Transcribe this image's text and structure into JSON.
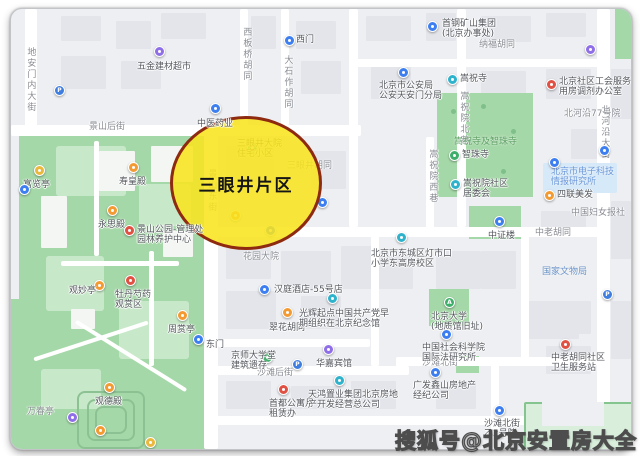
{
  "overlay": {
    "label": "三眼井片区"
  },
  "watermark": {
    "text": "搜狐号@北京安置房大全"
  },
  "colors": {
    "ellipse_fill": "rgba(248,228,31,0.88)",
    "ellipse_border": "#8e2a10",
    "park_green": "#a5d8a8",
    "road": "#ffffff",
    "highlight_block_blue": "#d6e9f8",
    "poi": {
      "B": "#3d7ef0",
      "T": "#2fb3cc",
      "G": "#3fae6a",
      "O": "#f39a33",
      "R": "#e05043",
      "P": "#8f6fe8",
      "K": "#3f7de0",
      "Y": "#e9b83d"
    }
  },
  "map": {
    "street_labels": [
      {
        "t": "地安门内大街",
        "x": 14,
        "y": 38,
        "v": 1
      },
      {
        "t": "景山后街",
        "x": 78,
        "y": 113
      },
      {
        "t": "西板桥胡同",
        "x": 230,
        "y": 18,
        "v": 1
      },
      {
        "t": "大石作胡同",
        "x": 271,
        "y": 46,
        "v": 1
      },
      {
        "t": "纳福胡同",
        "x": 468,
        "y": 31
      },
      {
        "t": "嵩祝院北巷",
        "x": 447,
        "y": 82,
        "v": 1
      },
      {
        "t": "景山东街",
        "x": 195,
        "y": 160,
        "v": 1
      },
      {
        "t": "嵩祝院西巷",
        "x": 416,
        "y": 140,
        "v": 1
      },
      {
        "t": "中老胡同",
        "x": 524,
        "y": 219
      },
      {
        "t": "沙滩后街",
        "x": 246,
        "y": 359
      },
      {
        "t": "沙滩北街",
        "x": 411,
        "y": 349
      },
      {
        "t": "北河沿大街",
        "x": 588,
        "y": 96,
        "v": 1
      },
      {
        "t": "花园大院",
        "x": 232,
        "y": 243
      },
      {
        "t": "万春亭",
        "x": 16,
        "y": 398
      },
      {
        "t": "北河沿77号院",
        "x": 553,
        "y": 100
      },
      {
        "t": "中国妇女报社",
        "x": 560,
        "y": 199
      }
    ],
    "area_labels": [
      {
        "t": "嵩祝寺及智珠寺",
        "x": 443,
        "y": 128,
        "c": "#5d9e63"
      },
      {
        "t": "国家文物局",
        "x": 531,
        "y": 258,
        "c": "#6b93c8"
      },
      {
        "t": "北京市电子科技\n情报研究所",
        "x": 540,
        "y": 158,
        "c": "#6b97d9"
      }
    ],
    "pois": [
      {
        "x": 147,
        "y": 41,
        "c": "P",
        "l": "五金建材超市",
        "lx": 126,
        "ly": 53
      },
      {
        "x": 203,
        "y": 98,
        "c": "B",
        "l": "中医药业",
        "lx": 186,
        "ly": 110
      },
      {
        "x": 47,
        "y": 80,
        "c": "K",
        "g": "P"
      },
      {
        "x": 277,
        "y": 30,
        "c": "B",
        "l": "西门",
        "lx": 285,
        "ly": 26
      },
      {
        "x": 420,
        "y": 16,
        "c": "B",
        "l": "首钢矿山集团\n(北京办事处)",
        "lx": 431,
        "ly": 10
      },
      {
        "x": 391,
        "y": 62,
        "c": "B",
        "l": "北京市公安局\n公安天安门分局",
        "lx": 368,
        "ly": 72
      },
      {
        "x": 440,
        "y": 69,
        "c": "T",
        "l": "嵩祝寺",
        "lx": 449,
        "ly": 65
      },
      {
        "x": 539,
        "y": 74,
        "c": "R",
        "l": "北京社区工会服务\n用房调剂办公室",
        "lx": 548,
        "ly": 68
      },
      {
        "x": 592,
        "y": 140,
        "c": "B"
      },
      {
        "x": 578,
        "y": 39,
        "c": "P"
      },
      {
        "x": 442,
        "y": 145,
        "c": "G",
        "l": "智珠寺",
        "lx": 451,
        "ly": 141
      },
      {
        "x": 443,
        "y": 174,
        "c": "T",
        "l": "嵩祝院社区\n居委会",
        "lx": 452,
        "ly": 170
      },
      {
        "x": 542,
        "y": 152,
        "c": "B"
      },
      {
        "x": 537,
        "y": 185,
        "c": "O",
        "l": "四联美发",
        "lx": 546,
        "ly": 181
      },
      {
        "x": 487,
        "y": 211,
        "c": "B",
        "l": "中证楼",
        "lx": 477,
        "ly": 222
      },
      {
        "x": 389,
        "y": 227,
        "c": "T",
        "l": "北京市东城区灯市口\n小学东高房校区",
        "lx": 360,
        "ly": 240
      },
      {
        "x": 437,
        "y": 292,
        "c": "G",
        "g": "A",
        "l": "北京大学\n(地质馆旧址)",
        "lx": 420,
        "ly": 303
      },
      {
        "x": 434,
        "y": 324,
        "c": "B",
        "l": "中国社会科学院\n国际法研究所",
        "lx": 411,
        "ly": 334
      },
      {
        "x": 252,
        "y": 279,
        "c": "B",
        "l": "汉庭酒店-55号店",
        "lx": 263,
        "ly": 276
      },
      {
        "x": 275,
        "y": 302,
        "c": "O",
        "l": "翠花胡同",
        "lx": 258,
        "ly": 314
      },
      {
        "x": 320,
        "y": 288,
        "c": "T",
        "l": "光辉起点中国共产党早\n期组织在北京纪念馆",
        "lx": 288,
        "ly": 300
      },
      {
        "x": 255,
        "y": 347,
        "c": "G",
        "l": "京师大学堂\n建筑遗存",
        "lx": 220,
        "ly": 342
      },
      {
        "x": 285,
        "y": 354,
        "c": "K",
        "g": "P"
      },
      {
        "x": 316,
        "y": 339,
        "c": "P",
        "l": "华嘉宾馆",
        "lx": 305,
        "ly": 350
      },
      {
        "x": 271,
        "y": 379,
        "c": "R",
        "l": "首都公寓月\n租赁办",
        "lx": 258,
        "ly": 390
      },
      {
        "x": 327,
        "y": 370,
        "c": "T",
        "l": "天鸿置业集团北京房地\n产开发经营总公司",
        "lx": 297,
        "ly": 381
      },
      {
        "x": 423,
        "y": 362,
        "c": "B",
        "l": "广发鑫山房地产\n经纪公司",
        "lx": 402,
        "ly": 372
      },
      {
        "x": 487,
        "y": 400,
        "c": "B",
        "l": "沙滩北街\n乙2号院",
        "lx": 473,
        "ly": 410
      },
      {
        "x": 553,
        "y": 334,
        "c": "R",
        "l": "中老胡同社区\n卫生服务站",
        "lx": 540,
        "ly": 344
      },
      {
        "x": 595,
        "y": 284,
        "c": "K",
        "g": "P"
      },
      {
        "x": 186,
        "y": 329,
        "c": "B",
        "l": "东门",
        "lx": 195,
        "ly": 331
      },
      {
        "x": 27,
        "y": 160,
        "c": "Y",
        "l": "富览亭",
        "lx": 12,
        "ly": 171
      },
      {
        "x": 121,
        "y": 157,
        "c": "O",
        "l": "寿皇殿",
        "lx": 108,
        "ly": 168
      },
      {
        "x": 100,
        "y": 200,
        "c": "O",
        "l": "永思殿",
        "lx": 87,
        "ly": 211
      },
      {
        "x": 117,
        "y": 220,
        "c": "R",
        "l": "景山公园-管理处\n园林养护中心",
        "lx": 126,
        "ly": 216
      },
      {
        "x": 118,
        "y": 270,
        "c": "R",
        "l": "牡丹芍药\n观赏区",
        "lx": 104,
        "ly": 281
      },
      {
        "x": 87,
        "y": 275,
        "c": "O",
        "l": "观妙亭",
        "lx": 58,
        "ly": 277
      },
      {
        "x": 170,
        "y": 305,
        "c": "O",
        "l": "周赏亭",
        "lx": 157,
        "ly": 316
      },
      {
        "x": 97,
        "y": 377,
        "c": "O",
        "l": "观德殿",
        "lx": 84,
        "ly": 388
      },
      {
        "x": 60,
        "y": 407,
        "c": "P"
      },
      {
        "x": 88,
        "y": 420,
        "c": "O"
      },
      {
        "x": 138,
        "y": 432,
        "c": "Y"
      },
      {
        "x": 12,
        "y": 179,
        "c": "B"
      },
      {
        "x": 240,
        "y": 137,
        "c": "T",
        "under": 1,
        "l": "三眼井大院\n住宅小区",
        "lx": 226,
        "ly": 130
      },
      {
        "x": 310,
        "y": 192,
        "c": "B",
        "under": 1
      },
      {
        "x": 223,
        "y": 205,
        "c": "O",
        "under": 1
      },
      {
        "x": 258,
        "y": 220,
        "c": "B",
        "under": 1
      }
    ],
    "under_labels": [
      {
        "t": "三眼井胡同",
        "x": 276,
        "y": 152
      }
    ]
  }
}
